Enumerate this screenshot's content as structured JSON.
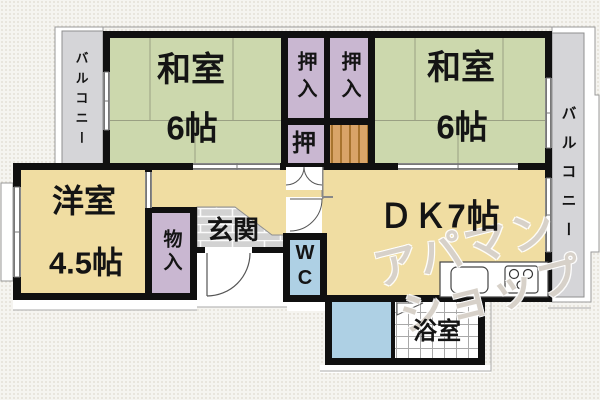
{
  "plan": {
    "rooms": {
      "washitsu_left": {
        "name": "和室",
        "size": "6帖"
      },
      "washitsu_right": {
        "name": "和室",
        "size": "6帖"
      },
      "youshitsu": {
        "name": "洋室",
        "size": "4.5帖"
      },
      "dk": {
        "name": "ＤＫ7帖"
      },
      "genkan": {
        "name": "玄関"
      },
      "wc": {
        "name": "WC"
      },
      "bathroom": {
        "name": "浴室"
      },
      "oshiire_left": {
        "name": "押入"
      },
      "oshiire_right": {
        "name": "押入"
      },
      "oshi": {
        "name": "押"
      },
      "monoire": {
        "name": "物入"
      },
      "balcony_left": {
        "name": "バルコニー"
      },
      "balcony_right": {
        "name": "バルコニー"
      }
    },
    "watermark": {
      "line1": "アパマン",
      "line2": "ショップ"
    },
    "colors": {
      "tatami_green": "#ccd8ad",
      "floor_yellow": "#f0dda2",
      "closet_purple": "#c9b7d1",
      "water_blue": "#aed0e4",
      "balcony_gray": "#d5d5d8",
      "shelf_orange": "#d9a468",
      "wall_black": "#101010"
    }
  }
}
